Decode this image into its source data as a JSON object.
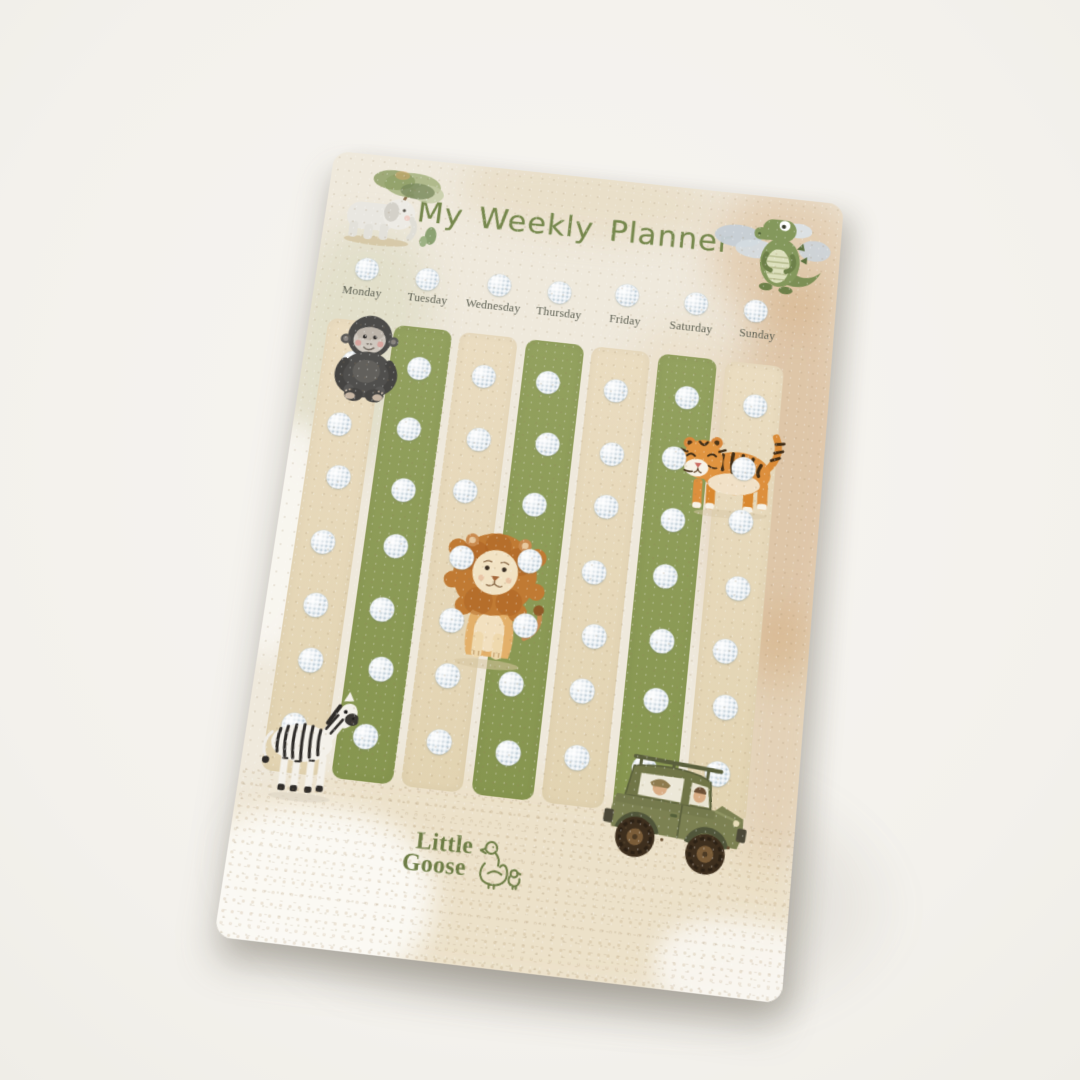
{
  "scene": {
    "background": "#f4f2ed"
  },
  "board": {
    "title": "My Weekly Planner",
    "days": [
      "Monday",
      "Tuesday",
      "Wednesday",
      "Thursday",
      "Friday",
      "Saturday",
      "Sunday"
    ],
    "logo": {
      "line1": "Little",
      "line2": "Goose"
    },
    "dots": {
      "header_count": 7,
      "rows_per_column": 7
    },
    "stickers": [
      {
        "id": "elephant-with-tree",
        "label": "watercolor elephant under tree"
      },
      {
        "id": "crocodile-with-clouds",
        "label": "watercolor crocodile with clouds"
      },
      {
        "id": "gorilla",
        "label": "watercolor gorilla"
      },
      {
        "id": "tiger",
        "label": "watercolor tiger"
      },
      {
        "id": "lion",
        "label": "watercolor lion"
      },
      {
        "id": "zebra",
        "label": "watercolor zebra"
      },
      {
        "id": "safari-jeep",
        "label": "watercolor safari jeep"
      },
      {
        "id": "goose-logo",
        "label": "Little Goose line-art goose and gosling"
      }
    ],
    "colors": {
      "board_paper": "#efe9dc",
      "column_green": "#8c9a59",
      "column_cream": "#e6d8b9",
      "title_green": "#76884d",
      "day_label": "#5c5f52",
      "logo_green": "#6d7d45",
      "velcro_dot": "#e9eff3"
    }
  }
}
